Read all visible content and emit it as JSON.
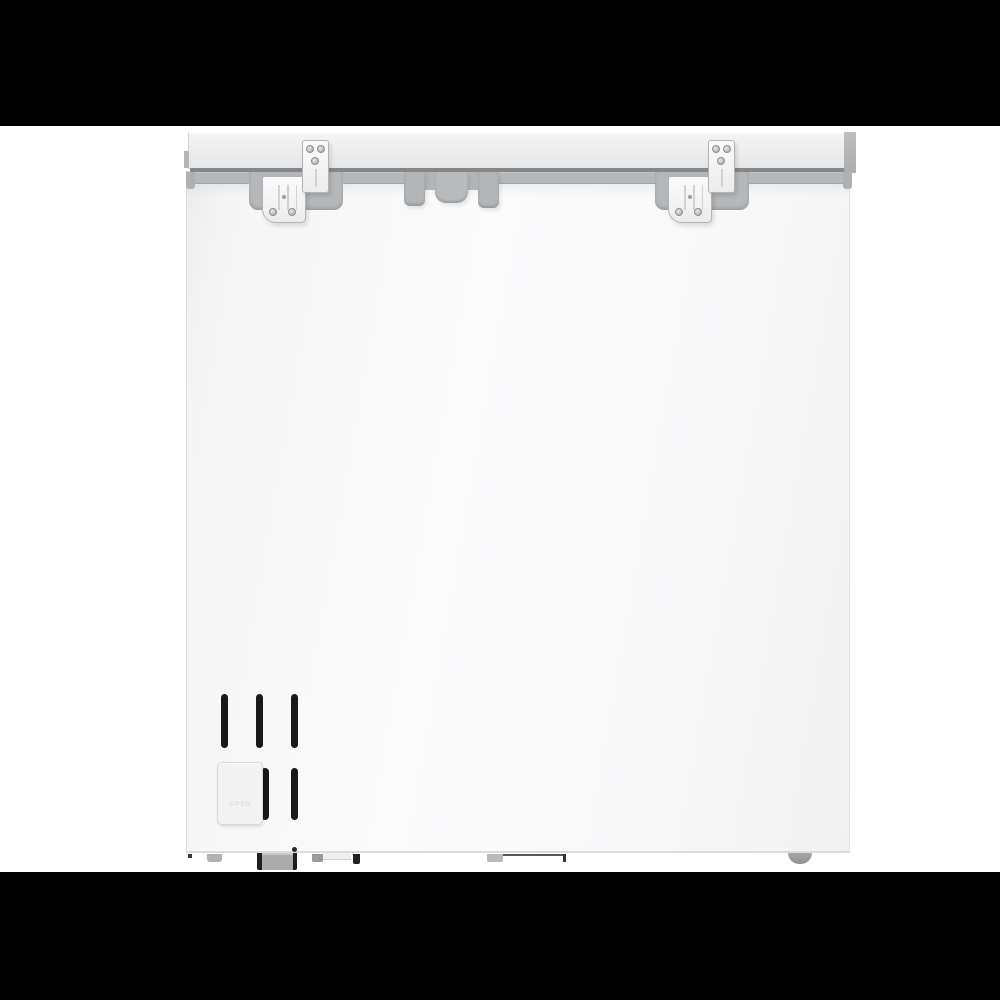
{
  "scene": {
    "type": "product-photo",
    "subject": "chest freezer rear view",
    "colors": {
      "letterbox": "#000000",
      "background": "#ffffff",
      "body": "#f8f8f9",
      "lid": "#ededee",
      "lid_cap": "#b3b6b8",
      "trim_dark": "#85888a",
      "trim": "#b5b8ba",
      "hinge": "#f4f4f5",
      "hinge_border": "#b3b3b5",
      "screw": "#9b9da0",
      "vent_slot": "#19191b",
      "panel": "#f3f3f4",
      "panel_border": "#d7d7d8",
      "panel_label_color": "#e0e0e2",
      "junction_box": "#a9abad",
      "foot": "#8f9193",
      "foot_small": "#b0b2b4"
    }
  },
  "drain_panel": {
    "label": "OPEN"
  }
}
